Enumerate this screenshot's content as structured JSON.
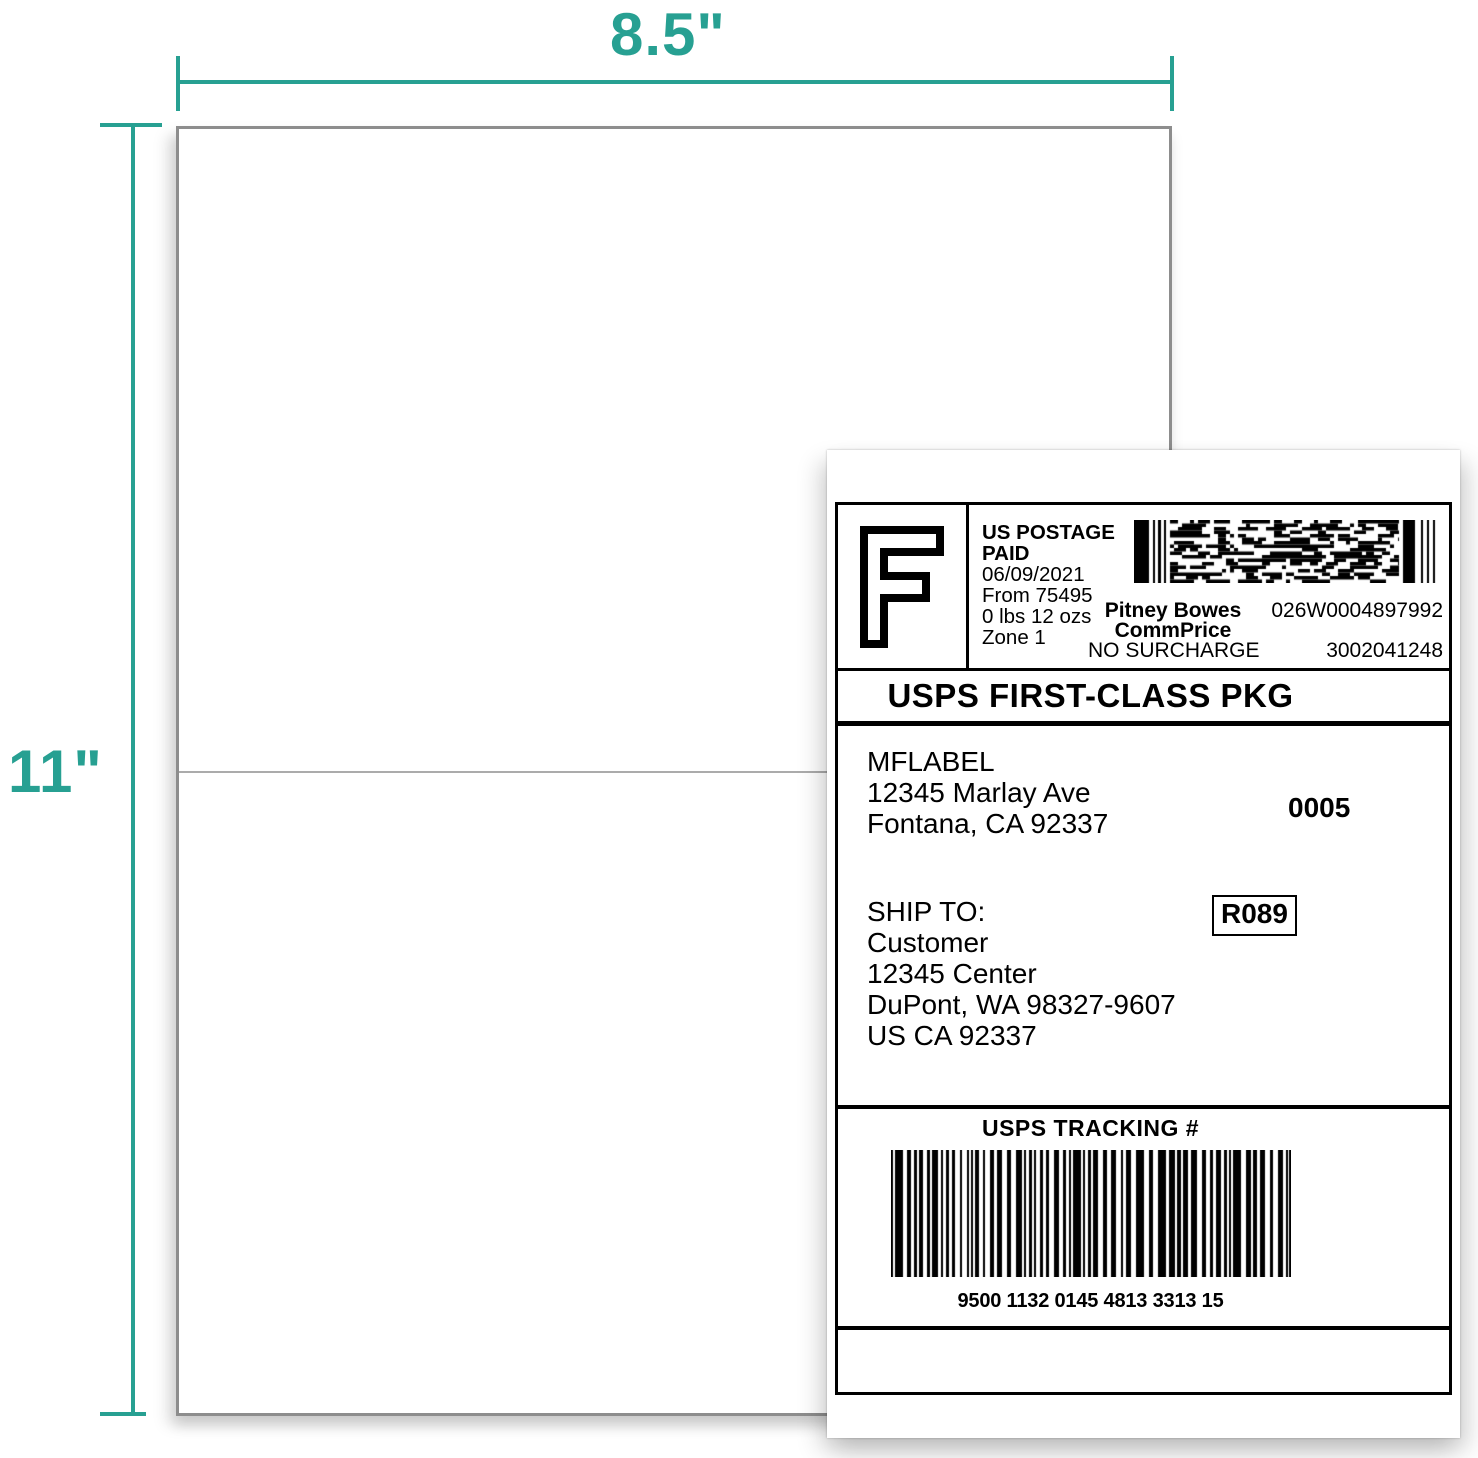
{
  "accent_color": "#27a092",
  "dimensions": {
    "paper_width": "8.5\"",
    "label_width": "8.5\"",
    "label_height": "5.5\"",
    "paper_height": "11\""
  },
  "shipping_label": {
    "postage": {
      "rate_mark": "F",
      "paid_line1": "US POSTAGE",
      "paid_line2": "PAID",
      "date": "06/09/2021",
      "origin": "From 75495",
      "weight": "0 lbs 12 ozs",
      "zone": "Zone 1",
      "carrier": "Pitney Bowes",
      "meter_number": "026W0004897992",
      "rate_program": "CommPrice",
      "surcharge": "NO SURCHARGE",
      "serial_number": "3002041248"
    },
    "service": "USPS FIRST-CLASS PKG",
    "from": {
      "name": "MFLABEL",
      "street": "12345 Marlay Ave",
      "city": "Fontana, CA 92337",
      "batch_number": "0005"
    },
    "ship_to": {
      "heading": "SHIP TO:",
      "route_code": "R089",
      "name": "Customer",
      "street": "12345 Center",
      "city": "DuPont, WA 98327-9607",
      "country": "US CA 92337"
    },
    "tracking": {
      "heading": "USPS TRACKING #",
      "number": "9500 1132 0145 4813 3313 15"
    }
  }
}
